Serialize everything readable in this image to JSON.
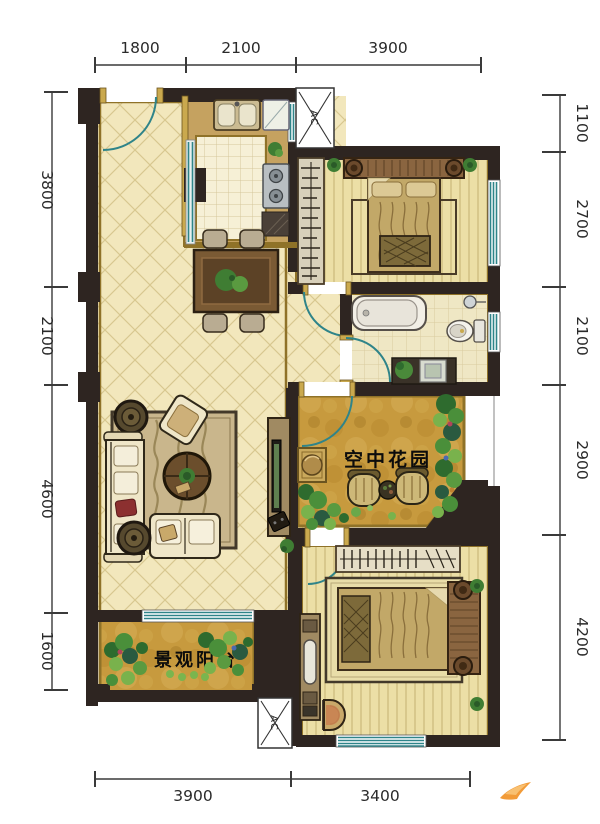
{
  "plan": {
    "rooms": {
      "sky_garden_label": "空中花园",
      "balcony_label": "景观阳台"
    },
    "equipment": {
      "ac_top_label": "AC",
      "ac_bottom_label": "AC"
    }
  },
  "dimensions": {
    "top": [
      "1800",
      "2100",
      "3900"
    ],
    "bottom": [
      "3900",
      "3400"
    ],
    "left": [
      "3800",
      "2100",
      "4600",
      "1600"
    ],
    "right": [
      "1100",
      "2700",
      "2100",
      "2900",
      "4200"
    ]
  },
  "colors": {
    "wall": "#2e2521",
    "gold_trim": "#8f7228",
    "door_window_teal": "#2f8489",
    "floor_cream": "#f2e7bc",
    "floor_gold": "#c79a3e",
    "floor_plank": "#ecdfa6",
    "brand_orange": "#f29b38"
  }
}
